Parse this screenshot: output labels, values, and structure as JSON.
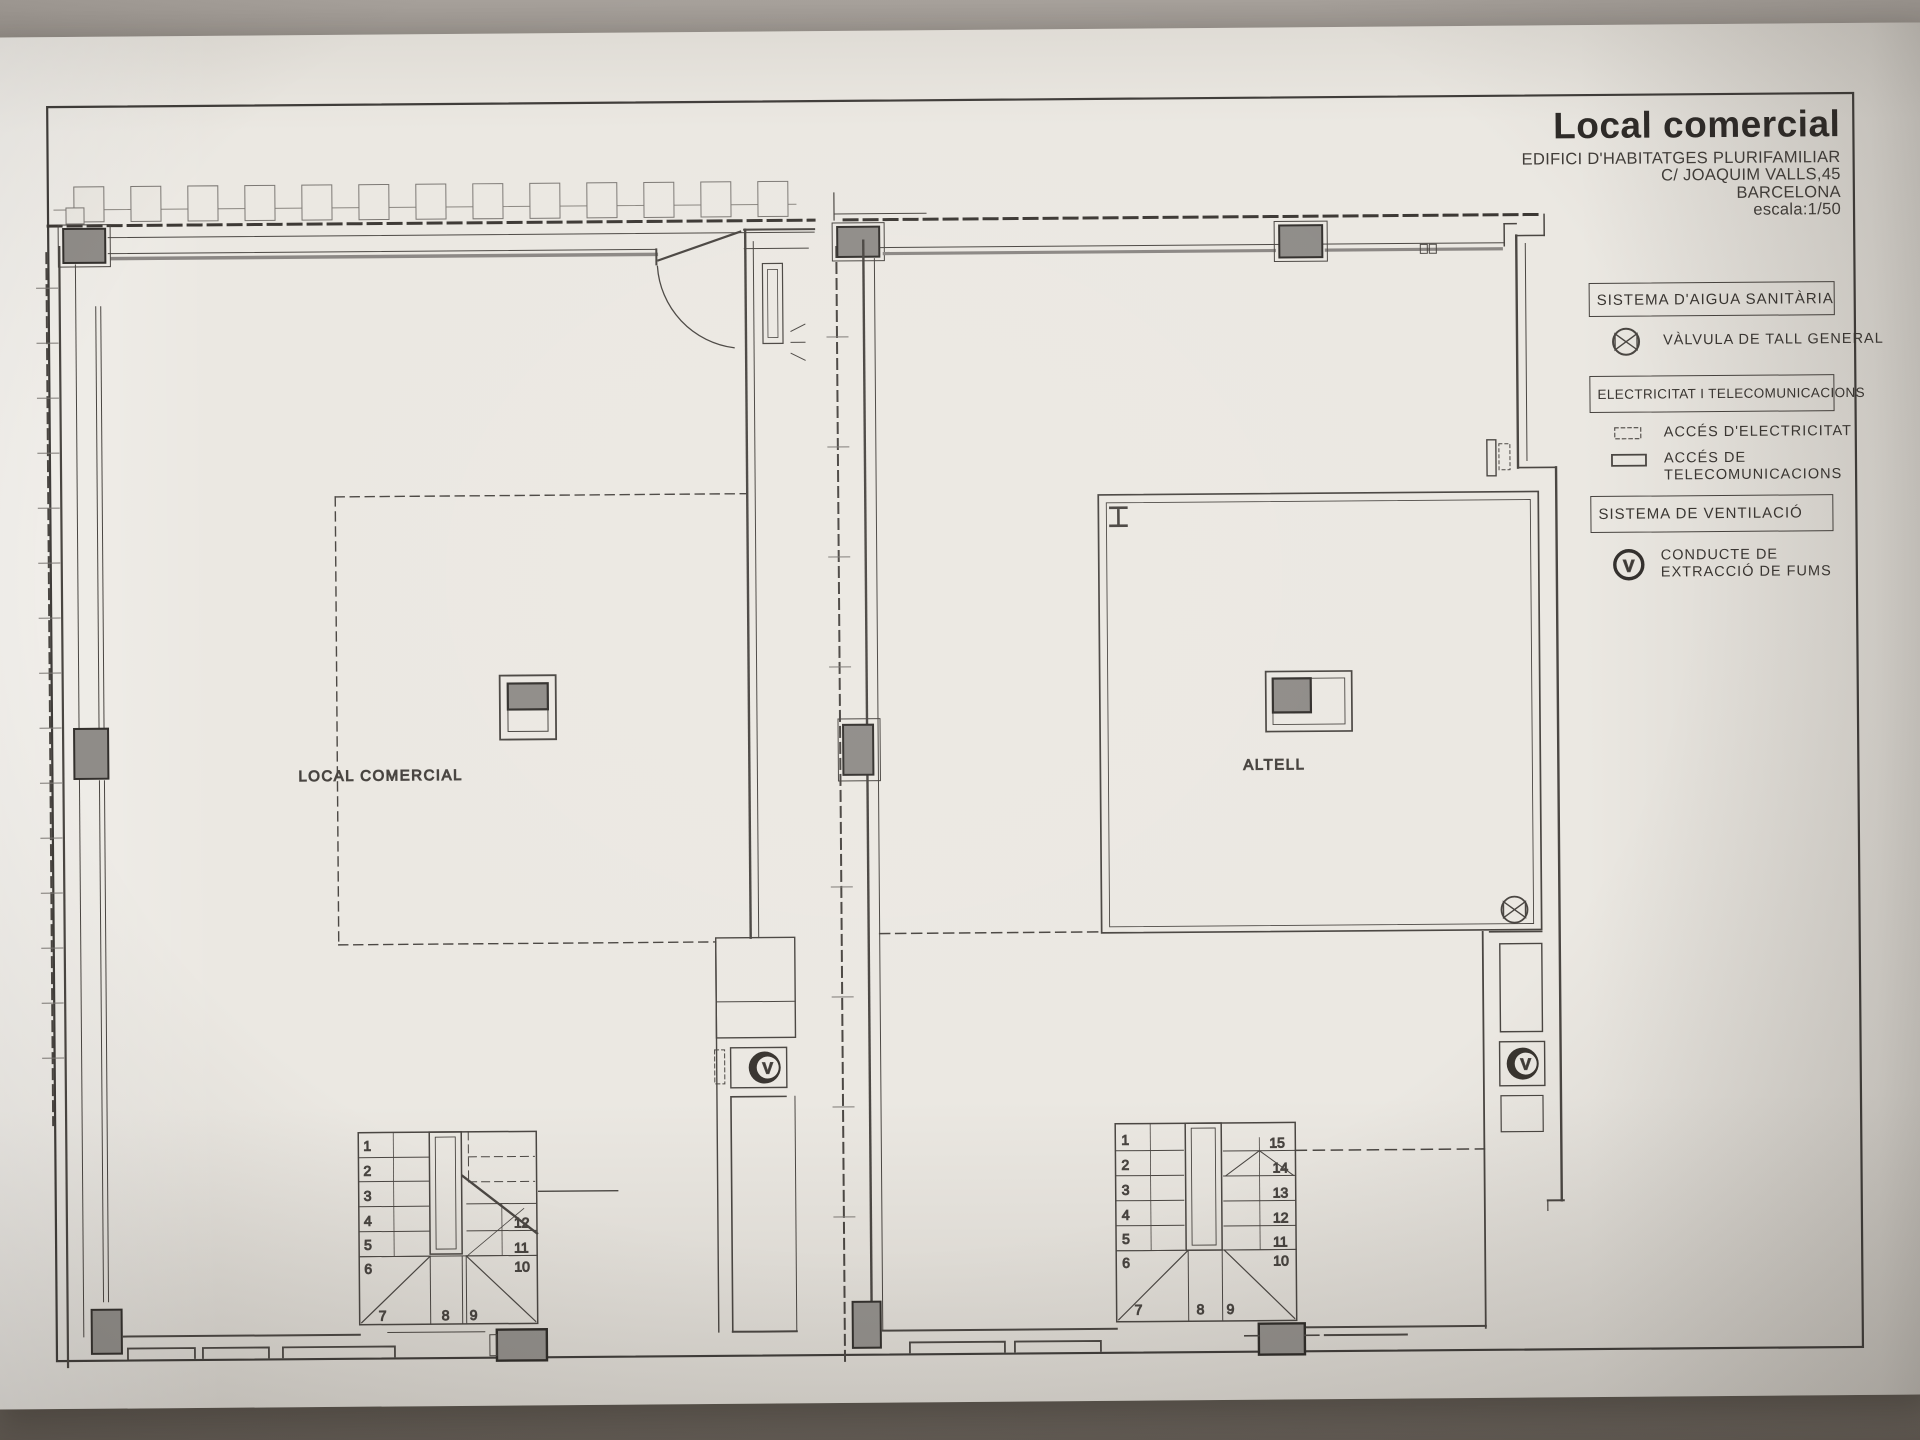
{
  "title_block": {
    "title": "Local comercial",
    "line1": "EDIFICI D'HABITATGES PLURIFAMILIAR",
    "line2": "C/ JOAQUIM VALLS,45",
    "line3": "BARCELONA",
    "scale": "escala:1/50"
  },
  "legend": {
    "sections": [
      {
        "title": "SISTEMA D'AIGUA SANITÀRIA",
        "items": [
          {
            "symbol": "valve-icon",
            "label": "VÀLVULA DE TALL GENERAL"
          }
        ]
      },
      {
        "title": "ELECTRICITAT I TELECOMUNICACIONS",
        "items": [
          {
            "symbol": "electricity-access-icon",
            "label": "ACCÉS D'ELECTRICITAT"
          },
          {
            "symbol": "telecom-access-icon",
            "label": "ACCÉS DE TELECOMUNICACIONS"
          }
        ]
      },
      {
        "title": "SISTEMA DE VENTILACIÓ",
        "items": [
          {
            "symbol": "smoke-extraction-icon",
            "label": "CONDUCTE DE EXTRACCIÓ DE FUMS"
          }
        ]
      }
    ]
  },
  "plans": {
    "left": {
      "label": "LOCAL COMERCIAL",
      "stair_numbers": [
        "1",
        "2",
        "3",
        "4",
        "5",
        "6",
        "7",
        "8",
        "9",
        "10",
        "11",
        "12"
      ]
    },
    "right": {
      "label": "ALTELL",
      "stair_numbers": [
        "1",
        "2",
        "3",
        "4",
        "5",
        "6",
        "7",
        "8",
        "9",
        "10",
        "11",
        "12",
        "13",
        "14",
        "15"
      ]
    }
  },
  "symbols": {
    "ventilation_letter": "V"
  },
  "colors": {
    "paper": "#ebe8e2",
    "ink": "#4a4642",
    "pillar_fill": "#8f8c88",
    "backdrop": "#8d8780"
  }
}
